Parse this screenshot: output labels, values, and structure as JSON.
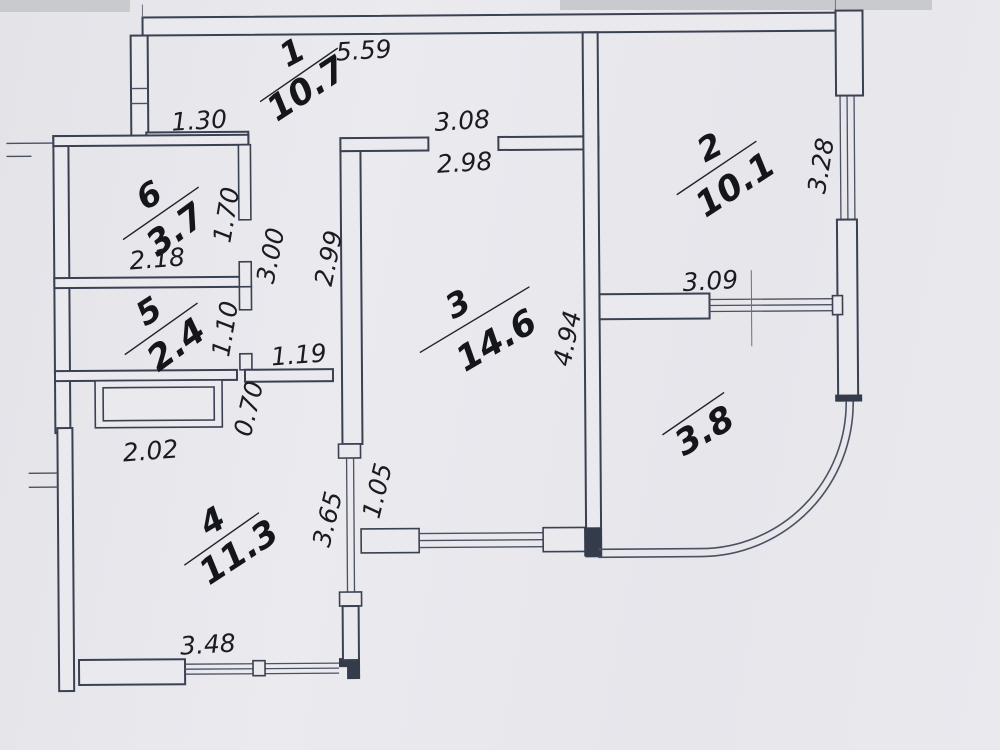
{
  "plan": {
    "title": "apartment-floor-plan",
    "rooms": [
      {
        "number": "1",
        "area": "10.7"
      },
      {
        "number": "2",
        "area": "10.1"
      },
      {
        "number": "3",
        "area": "14.6"
      },
      {
        "number": "4",
        "area": "11.3"
      },
      {
        "number": "5",
        "area": "2.4"
      },
      {
        "number": "6",
        "area": "3.7"
      }
    ],
    "balcony": {
      "area": "3.8"
    },
    "dims": {
      "top_width": "5.59",
      "hall_left": "1.30",
      "room3_top_outer": "3.08",
      "room3_top_inner": "2.98",
      "room2_side": "3.28",
      "room6_side": "1.70",
      "room6_width": "2.18",
      "corridor_len_left": "3.00",
      "corridor_len_right": "2.99",
      "room5_side": "1.10",
      "corridor_width": "1.19",
      "niche_depth": "0.70",
      "room4_top_width": "2.02",
      "room3_side": "4.94",
      "balcony_width": "3.09",
      "room3_window_side": "1.05",
      "room4_side": "3.65",
      "room4_bottom_width": "3.48"
    },
    "colors": {
      "paper": "#e9e9ee",
      "line": "#3a4152",
      "text": "#15161b"
    }
  }
}
